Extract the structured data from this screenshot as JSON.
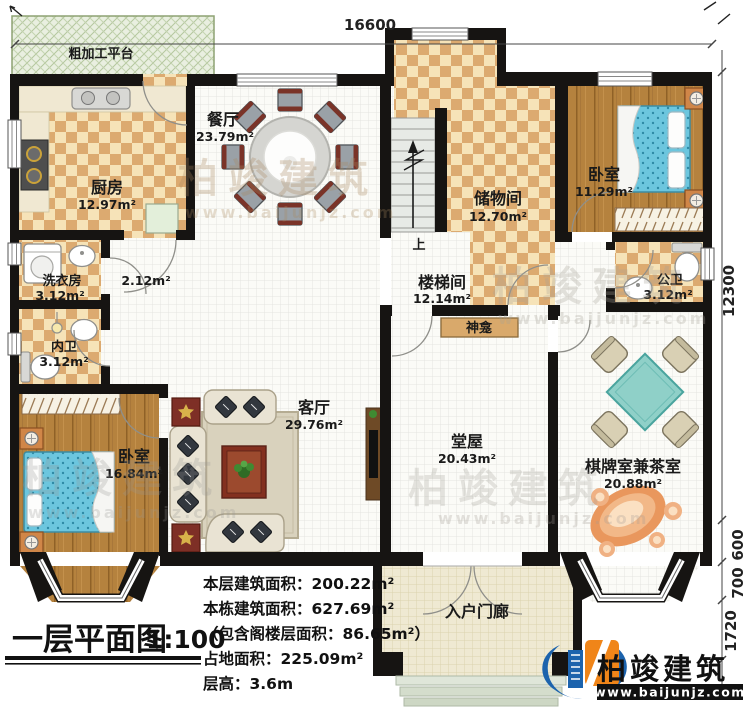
{
  "document": {
    "title": "一层平面图",
    "scale": "1:100",
    "stats": {
      "floor_area": "本层建筑面积：200.22m²",
      "building_area": "本栋建筑面积：627.69m²",
      "attic_area": "（包含阁楼层面积：86.65m²）",
      "footprint_area": "占地面积：225.09m²",
      "floor_height": "层高：3.6m"
    }
  },
  "dimensions": {
    "top_width": "16600",
    "right_height": "12300",
    "bay_a": "600",
    "bay_b": "700",
    "porch_depth": "1720"
  },
  "rooms": {
    "platform": {
      "label": "粗加工平台"
    },
    "kitchen": {
      "label": "厨房",
      "area": "12.97m²"
    },
    "dining": {
      "label": "餐厅",
      "area": "23.79m²"
    },
    "storage": {
      "label": "储物间",
      "area": "12.70m²"
    },
    "bedroom_tr": {
      "label": "卧室",
      "area": "11.29m²"
    },
    "stair_hall": {
      "label": "楼梯间",
      "area": "12.14m²"
    },
    "laundry": {
      "label": "洗衣房",
      "area": "3.12m²"
    },
    "inner_bath": {
      "label": "内卫",
      "area": "3.12m²"
    },
    "public_bath": {
      "label": "公卫",
      "area": "3.12m²"
    },
    "bedroom_bl": {
      "label": "卧室",
      "area": "16.84m²"
    },
    "living": {
      "label": "客厅",
      "area": "29.76m²"
    },
    "hall": {
      "label": "堂屋",
      "area": "20.43m²"
    },
    "chess": {
      "label": "棋牌室兼茶室",
      "area": "20.88m²"
    },
    "porch": {
      "label": "入户门廊"
    },
    "shrine": {
      "label": "神龛"
    },
    "corridor": {
      "area": "2.12m²"
    },
    "stairs_up": {
      "label": "上"
    }
  },
  "brand": {
    "name": "柏竣建筑",
    "website": "www.baijunjz.com"
  },
  "colors": {
    "wall": "#161412",
    "checker_light": "#f6e3b8",
    "checker_dark": "#dcaa70",
    "wood": "#b5823e",
    "bed": "#6cc6de",
    "tea_table": "#8fd0c8",
    "brand_blue": "#1c63ad",
    "brand_orange": "#f08519"
  }
}
